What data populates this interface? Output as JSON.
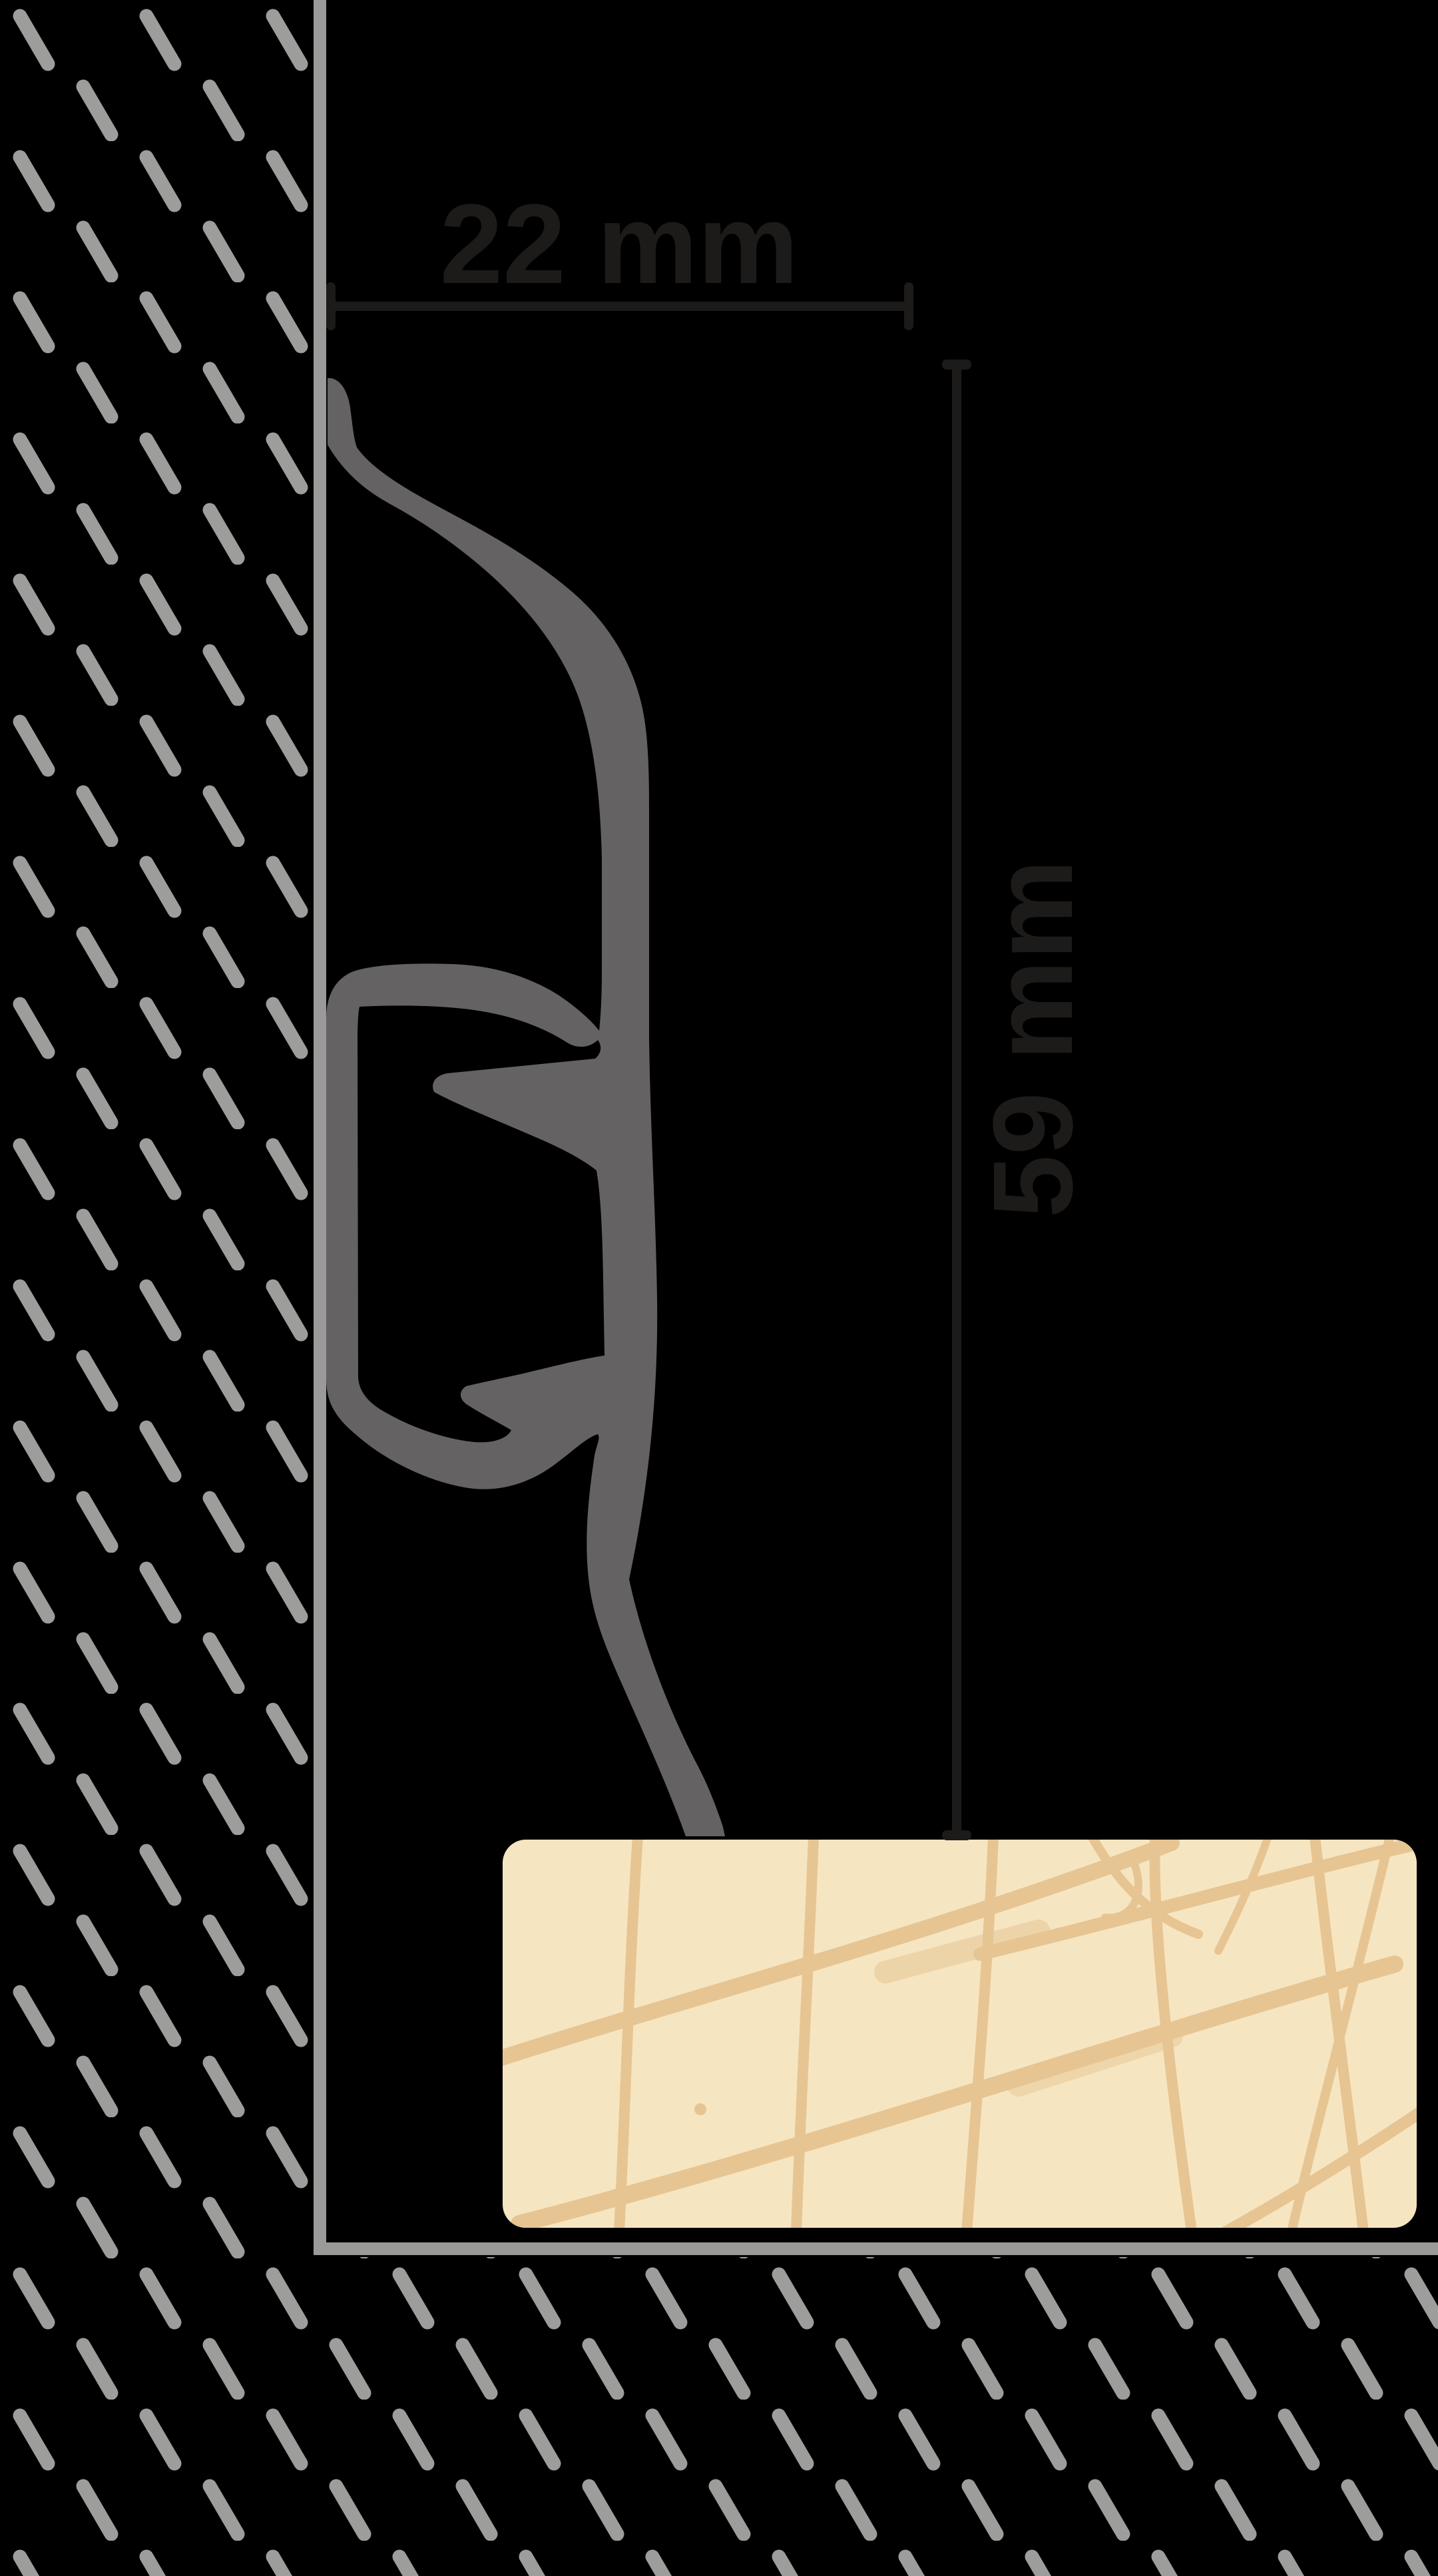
{
  "diagram": {
    "name": "skirting-profile-cross-section",
    "dimensions": {
      "width": {
        "label": "22 mm"
      },
      "height": {
        "label": "59 mm"
      }
    },
    "elements": {
      "wall": "hatched wall section",
      "floor_board": "wood floor board",
      "profile": "skirting profile with clip channel"
    }
  },
  "colors": {
    "background": "#000000",
    "wall_hatch": "#9d9d9b",
    "wall_line": "#9a9a98",
    "profile": "#656263",
    "dimension": "#1d1b19",
    "floor_board": "#f6e5c1",
    "floor_grain": "#e6c593"
  }
}
